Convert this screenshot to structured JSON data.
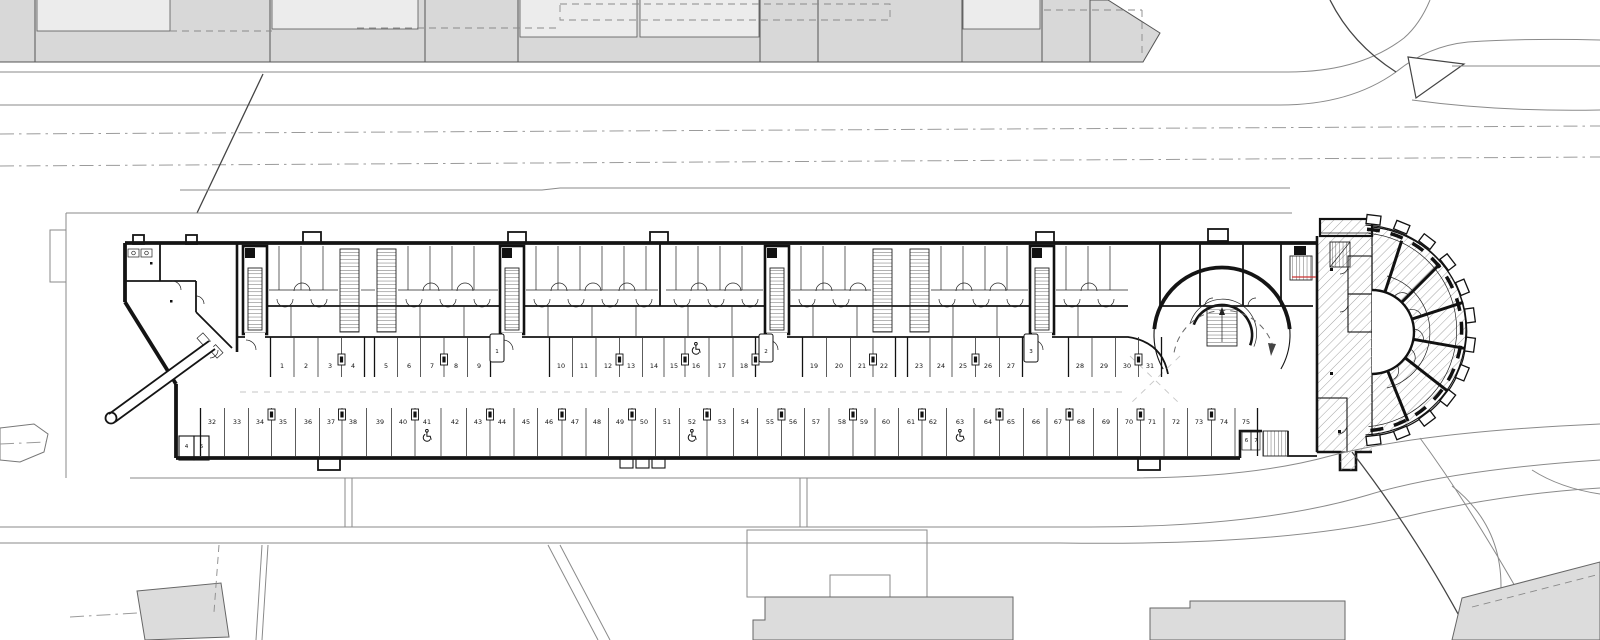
{
  "drawing": {
    "kind": "architectural-floor-plan",
    "level": "parking-garage-level"
  },
  "colors": {
    "paper": "#ffffff",
    "wall": "#141414",
    "context_building": "#d8d8d8",
    "context_inner": "#ececec",
    "context_lower": "#dcdcdc",
    "road": "#8a8a8a",
    "centerline": "#9b9b9b",
    "guide": "#c6c6c6",
    "section": "#cc3333"
  },
  "icons": {
    "accessible": "wheelchair-icon"
  },
  "parking": {
    "row_top": {
      "label_y": 368,
      "stalls": [
        {
          "n": "1",
          "x": 282
        },
        {
          "n": "2",
          "x": 306
        },
        {
          "n": "3",
          "x": 330
        },
        {
          "n": "4",
          "x": 353
        },
        {
          "n": "5",
          "x": 386
        },
        {
          "n": "6",
          "x": 409
        },
        {
          "n": "7",
          "x": 432
        },
        {
          "n": "8",
          "x": 456
        },
        {
          "n": "9",
          "x": 479
        },
        {
          "n": "10",
          "x": 561
        },
        {
          "n": "11",
          "x": 584
        },
        {
          "n": "12",
          "x": 608
        },
        {
          "n": "13",
          "x": 631
        },
        {
          "n": "14",
          "x": 654
        },
        {
          "n": "15",
          "x": 674
        },
        {
          "n": "16",
          "x": 696,
          "accessible": true
        },
        {
          "n": "17",
          "x": 722
        },
        {
          "n": "18",
          "x": 744
        },
        {
          "n": "19",
          "x": 814
        },
        {
          "n": "20",
          "x": 839
        },
        {
          "n": "21",
          "x": 862
        },
        {
          "n": "22",
          "x": 884
        },
        {
          "n": "23",
          "x": 919
        },
        {
          "n": "24",
          "x": 941
        },
        {
          "n": "25",
          "x": 963
        },
        {
          "n": "26",
          "x": 988
        },
        {
          "n": "27",
          "x": 1011
        },
        {
          "n": "28",
          "x": 1080
        },
        {
          "n": "29",
          "x": 1104
        },
        {
          "n": "30",
          "x": 1127
        },
        {
          "n": "31",
          "x": 1150
        }
      ]
    },
    "row_bottom": {
      "label_y": 424,
      "stalls": [
        {
          "n": "32",
          "x": 212
        },
        {
          "n": "33",
          "x": 237
        },
        {
          "n": "34",
          "x": 260
        },
        {
          "n": "35",
          "x": 283
        },
        {
          "n": "36",
          "x": 308
        },
        {
          "n": "37",
          "x": 331
        },
        {
          "n": "38",
          "x": 353
        },
        {
          "n": "39",
          "x": 380
        },
        {
          "n": "40",
          "x": 403
        },
        {
          "n": "41",
          "x": 427,
          "accessible": true
        },
        {
          "n": "42",
          "x": 455
        },
        {
          "n": "43",
          "x": 478
        },
        {
          "n": "44",
          "x": 502
        },
        {
          "n": "45",
          "x": 526
        },
        {
          "n": "46",
          "x": 549
        },
        {
          "n": "47",
          "x": 575
        },
        {
          "n": "48",
          "x": 597
        },
        {
          "n": "49",
          "x": 620
        },
        {
          "n": "50",
          "x": 644
        },
        {
          "n": "51",
          "x": 667
        },
        {
          "n": "52",
          "x": 692,
          "accessible": true
        },
        {
          "n": "53",
          "x": 722
        },
        {
          "n": "54",
          "x": 745
        },
        {
          "n": "55",
          "x": 770
        },
        {
          "n": "56",
          "x": 793
        },
        {
          "n": "57",
          "x": 816
        },
        {
          "n": "58",
          "x": 842
        },
        {
          "n": "59",
          "x": 864
        },
        {
          "n": "60",
          "x": 886
        },
        {
          "n": "61",
          "x": 911
        },
        {
          "n": "62",
          "x": 933
        },
        {
          "n": "63",
          "x": 960,
          "accessible": true
        },
        {
          "n": "64",
          "x": 988
        },
        {
          "n": "65",
          "x": 1011
        },
        {
          "n": "66",
          "x": 1036
        },
        {
          "n": "67",
          "x": 1058
        },
        {
          "n": "68",
          "x": 1081
        },
        {
          "n": "69",
          "x": 1106
        },
        {
          "n": "70",
          "x": 1129
        },
        {
          "n": "71",
          "x": 1152
        },
        {
          "n": "72",
          "x": 1176
        },
        {
          "n": "73",
          "x": 1199
        },
        {
          "n": "74",
          "x": 1224
        },
        {
          "n": "75",
          "x": 1246
        }
      ]
    },
    "bays": [
      {
        "label": "1",
        "x": 497,
        "y": 351
      },
      {
        "label": "2",
        "x": 766,
        "y": 351
      },
      {
        "label": "3",
        "x": 1031,
        "y": 351
      }
    ],
    "end_bays_left": [
      {
        "label": "4",
        "x": 186.5,
        "y": 448
      },
      {
        "label": "5",
        "x": 201.5,
        "y": 448
      }
    ],
    "end_bays_right": [
      {
        "label": "6",
        "x": 1246.5,
        "y": 442
      },
      {
        "label": "7",
        "x": 1256,
        "y": 442
      }
    ]
  }
}
